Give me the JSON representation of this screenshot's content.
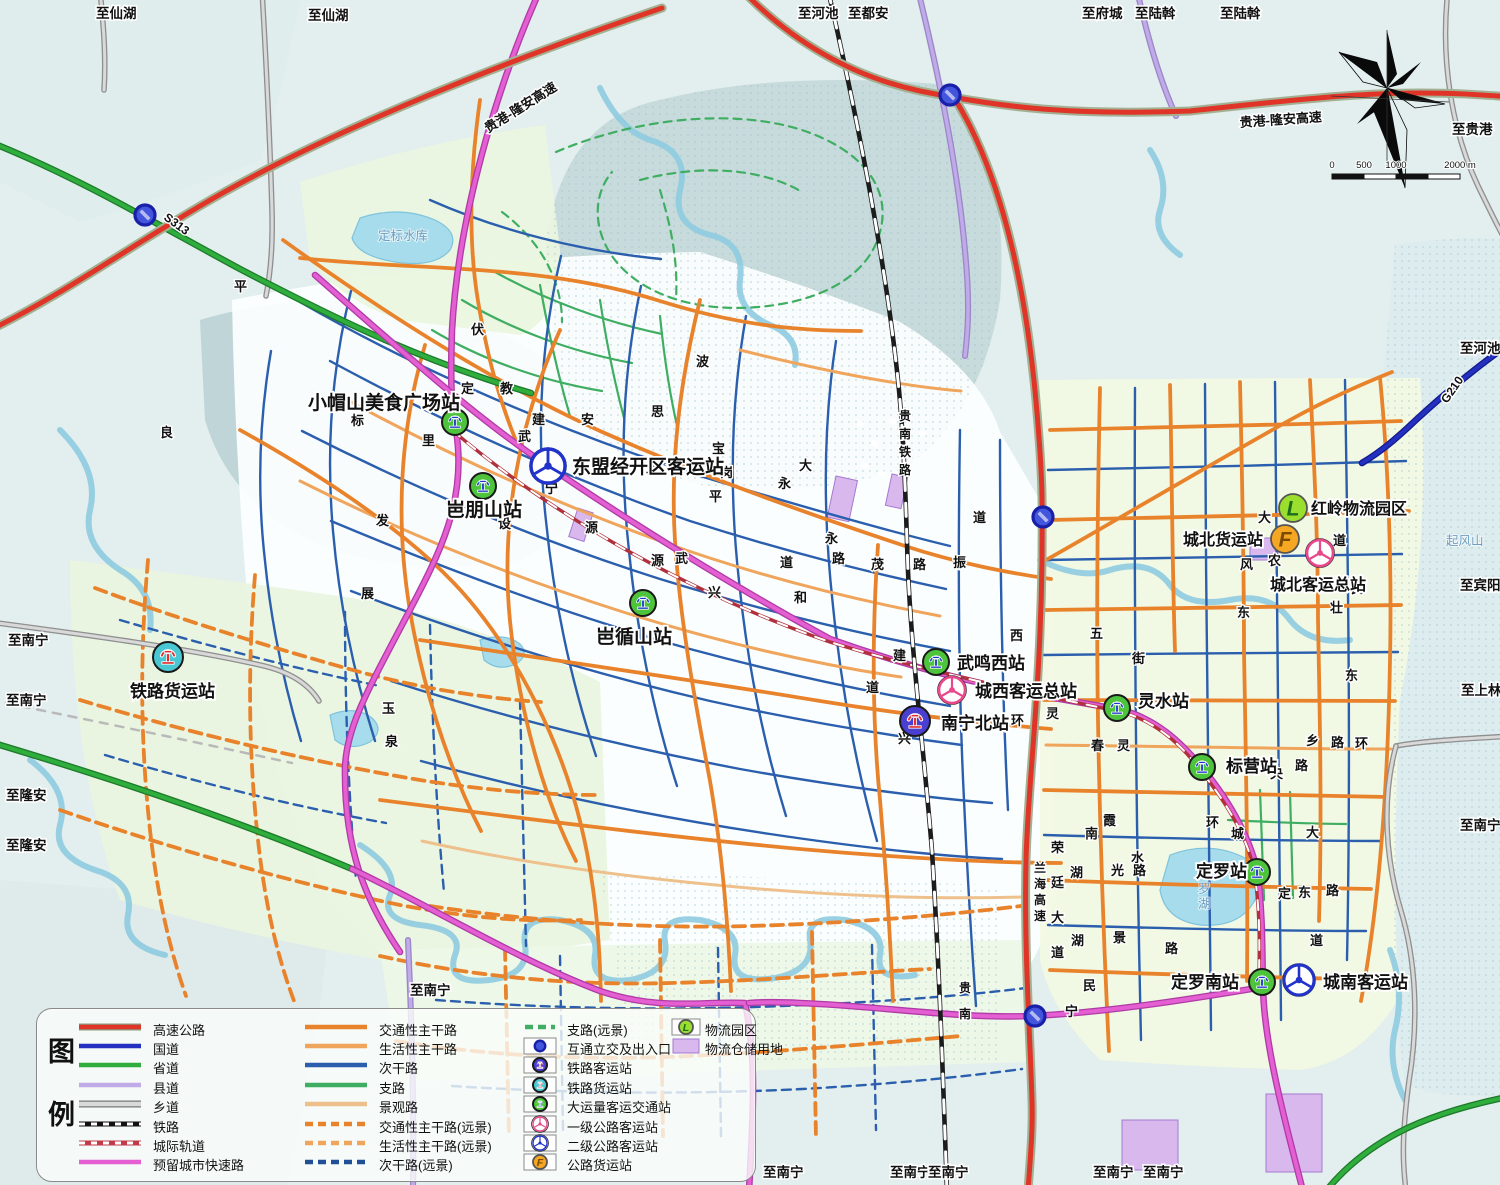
{
  "map": {
    "edge_labels": [
      {
        "text": "至仙湖",
        "x": 96,
        "y": 18
      },
      {
        "text": "至仙湖",
        "x": 308,
        "y": 20
      },
      {
        "text": "至河池",
        "x": 798,
        "y": 18
      },
      {
        "text": "至都安",
        "x": 848,
        "y": 18
      },
      {
        "text": "至府城",
        "x": 1082,
        "y": 18
      },
      {
        "text": "至陆斡",
        "x": 1135,
        "y": 18
      },
      {
        "text": "至陆斡",
        "x": 1220,
        "y": 18
      },
      {
        "text": "至贵港",
        "x": 1452,
        "y": 134
      },
      {
        "text": "至河池",
        "x": 1460,
        "y": 353
      },
      {
        "text": "至宾阳",
        "x": 1460,
        "y": 590
      },
      {
        "text": "至上林",
        "x": 1461,
        "y": 695
      },
      {
        "text": "至南宁",
        "x": 1460,
        "y": 830
      },
      {
        "text": "至南宁",
        "x": 8,
        "y": 645
      },
      {
        "text": "至南宁",
        "x": 6,
        "y": 705
      },
      {
        "text": "至隆安",
        "x": 6,
        "y": 800
      },
      {
        "text": "至隆安",
        "x": 6,
        "y": 850
      },
      {
        "text": "至南宁",
        "x": 410,
        "y": 995
      },
      {
        "text": "至南宁",
        "x": 763,
        "y": 1177
      },
      {
        "text": "至南宁",
        "x": 890,
        "y": 1177
      },
      {
        "text": "至南宁",
        "x": 928,
        "y": 1177
      },
      {
        "text": "至南宁",
        "x": 1093,
        "y": 1177
      },
      {
        "text": "至南宁",
        "x": 1143,
        "y": 1177
      }
    ],
    "route_labels": [
      {
        "text": "贵港-隆安高速",
        "x": 488,
        "y": 133,
        "rot": -32,
        "size": 13
      },
      {
        "text": "贵港-隆安高速",
        "x": 1240,
        "y": 127,
        "rot": -4,
        "size": 13
      },
      {
        "text": "S313",
        "x": 163,
        "y": 219,
        "rot": 36,
        "size": 12
      },
      {
        "text": "G210",
        "x": 1447,
        "y": 404,
        "rot": -55,
        "size": 12
      },
      {
        "text": "贵南铁路",
        "x": 899,
        "y": 420,
        "vsp": 18,
        "size": 12
      },
      {
        "text": "兰海高速",
        "x": 1034,
        "y": 872,
        "vsp": 16,
        "size": 12
      },
      {
        "text": "荣廷大道",
        "x": 1051,
        "y": 852,
        "vsp": 35,
        "size": 13
      },
      {
        "text": "贵南",
        "x": 959,
        "y": 992,
        "vsp": 26,
        "size": 12
      }
    ],
    "water_labels": [
      {
        "text": "定标水库",
        "x": 378,
        "y": 240
      },
      {
        "text": "起风山",
        "x": 1446,
        "y": 545
      },
      {
        "text": "定罗湖",
        "x": 1198,
        "y": 878,
        "vsp": 15
      }
    ],
    "road_chars": [
      [
        "良",
        160,
        437
      ],
      [
        "平",
        234,
        291
      ],
      [
        "伏",
        471,
        334
      ],
      [
        "定",
        461,
        393
      ],
      [
        "教",
        500,
        393
      ],
      [
        "标",
        351,
        425
      ],
      [
        "里",
        422,
        445
      ],
      [
        "建",
        532,
        424
      ],
      [
        "安",
        581,
        424
      ],
      [
        "思",
        651,
        416
      ],
      [
        "波",
        696,
        366
      ],
      [
        "宝",
        712,
        453
      ],
      [
        "岗",
        720,
        477
      ],
      [
        "永",
        778,
        488
      ],
      [
        "大",
        799,
        470
      ],
      [
        "平",
        709,
        501
      ],
      [
        "武",
        518,
        441
      ],
      [
        "宁",
        545,
        493
      ],
      [
        "华",
        646,
        475
      ],
      [
        "发",
        376,
        525
      ],
      [
        "设",
        498,
        528
      ],
      [
        "源",
        585,
        532
      ],
      [
        "武",
        675,
        563
      ],
      [
        "源",
        651,
        565
      ],
      [
        "展",
        361,
        598
      ],
      [
        "玉",
        382,
        713
      ],
      [
        "泉",
        385,
        746
      ],
      [
        "茂",
        871,
        569
      ],
      [
        "路",
        913,
        569
      ],
      [
        "振",
        953,
        567
      ],
      [
        "道",
        973,
        522
      ],
      [
        "西",
        1010,
        640
      ],
      [
        "五",
        1090,
        638
      ],
      [
        "建",
        893,
        660
      ],
      [
        "兴",
        898,
        743
      ],
      [
        "环",
        1011,
        725
      ],
      [
        "灵",
        1046,
        718
      ],
      [
        "春",
        1091,
        750
      ],
      [
        "灵",
        1117,
        750
      ],
      [
        "道",
        866,
        692
      ],
      [
        "街",
        1132,
        663
      ],
      [
        "兴",
        708,
        597
      ],
      [
        "和",
        794,
        602
      ],
      [
        "道",
        780,
        567
      ],
      [
        "路",
        832,
        563
      ],
      [
        "永",
        825,
        543
      ],
      [
        "大",
        1258,
        522
      ],
      [
        "道",
        1333,
        545
      ],
      [
        "风",
        1240,
        569
      ],
      [
        "农",
        1268,
        565
      ],
      [
        "民",
        1351,
        593
      ],
      [
        "东",
        1237,
        617
      ],
      [
        "乡",
        1306,
        745
      ],
      [
        "路",
        1331,
        747
      ],
      [
        "环",
        1355,
        748
      ],
      [
        "央",
        1270,
        778
      ],
      [
        "路",
        1295,
        770
      ],
      [
        "环",
        1206,
        827
      ],
      [
        "城",
        1231,
        838
      ],
      [
        "大",
        1306,
        837
      ],
      [
        "霞",
        1103,
        825
      ],
      [
        "水",
        1131,
        862
      ],
      [
        "光",
        1111,
        875
      ],
      [
        "路",
        1133,
        875
      ],
      [
        "定",
        1278,
        898
      ],
      [
        "东",
        1298,
        897
      ],
      [
        "路",
        1326,
        895
      ],
      [
        "景",
        1113,
        942
      ],
      [
        "路",
        1165,
        953
      ],
      [
        "道",
        1310,
        945
      ],
      [
        "南",
        1085,
        838
      ],
      [
        "湖",
        1070,
        877
      ],
      [
        "湖",
        1071,
        945
      ],
      [
        "民",
        1083,
        990
      ],
      [
        "宁",
        1065,
        1016
      ],
      [
        "东",
        1345,
        680
      ],
      [
        "壮",
        1330,
        612
      ]
    ],
    "stations": [
      {
        "name": "小帽山美食广场站",
        "type": "brt",
        "x": 455,
        "y": 422,
        "lx": 308,
        "ly": 409,
        "lsize": 19
      },
      {
        "name": "东盟经开区客运站",
        "type": "bus2",
        "x": 548,
        "y": 466,
        "r": 17,
        "lx": 572,
        "ly": 473,
        "lsize": 19
      },
      {
        "name": "岜朋山站",
        "type": "brt",
        "x": 483,
        "y": 486,
        "lx": 446,
        "ly": 516,
        "lsize": 19
      },
      {
        "name": "岜循山站",
        "type": "brt",
        "x": 643,
        "y": 603,
        "lx": 596,
        "ly": 643,
        "lsize": 19
      },
      {
        "name": "铁路货运站",
        "type": "rail-freight",
        "x": 168,
        "y": 657,
        "r": 15,
        "lx": 130,
        "ly": 697,
        "lsize": 17
      },
      {
        "name": "武鸣西站",
        "type": "brt",
        "x": 936,
        "y": 662,
        "lx": 957,
        "ly": 669,
        "lsize": 17
      },
      {
        "name": "城西客运总站",
        "type": "bus1",
        "x": 952,
        "y": 690,
        "lx": 975,
        "ly": 697,
        "lsize": 17
      },
      {
        "name": "南宁北站",
        "type": "rail-passenger",
        "x": 915,
        "y": 721,
        "r": 15,
        "lx": 941,
        "ly": 729,
        "lsize": 17
      },
      {
        "name": "灵水站",
        "type": "brt",
        "x": 1117,
        "y": 708,
        "lx": 1138,
        "ly": 707,
        "lsize": 17
      },
      {
        "name": "红岭物流园区",
        "type": "logistics",
        "x": 1293,
        "y": 508,
        "r": 14,
        "lx": 1311,
        "ly": 514,
        "lsize": 16
      },
      {
        "name": "城北货运站",
        "type": "freight",
        "x": 1285,
        "y": 539,
        "r": 14,
        "lx": 1183,
        "ly": 545,
        "lsize": 16
      },
      {
        "name": "城北客运总站",
        "type": "bus1",
        "x": 1320,
        "y": 553,
        "lx": 1270,
        "ly": 590,
        "lsize": 16
      },
      {
        "name": "标营站",
        "type": "brt",
        "x": 1202,
        "y": 767,
        "lx": 1226,
        "ly": 772,
        "lsize": 17
      },
      {
        "name": "定罗站",
        "type": "brt",
        "x": 1257,
        "y": 872,
        "lx": 1196,
        "ly": 877,
        "lsize": 17
      },
      {
        "name": "定罗南站",
        "type": "brt",
        "x": 1262,
        "y": 982,
        "lx": 1171,
        "ly": 988,
        "lsize": 17
      },
      {
        "name": "城南客运站",
        "type": "bus2",
        "x": 1299,
        "y": 980,
        "r": 15,
        "lx": 1323,
        "ly": 988,
        "lsize": 17
      }
    ],
    "interchanges": [
      [
        145,
        215
      ],
      [
        950,
        95
      ],
      [
        1043,
        517
      ],
      [
        1035,
        1016
      ]
    ],
    "scale_bar": {
      "labels": [
        "0",
        "500",
        "1000",
        "2000 m"
      ]
    }
  },
  "legend": {
    "title": "图例",
    "col1": [
      {
        "label": "高速公路",
        "sw": "line",
        "color": "#e03428",
        "casing": "#8a9a7a"
      },
      {
        "label": "国道",
        "sw": "line",
        "color": "#2330c0"
      },
      {
        "label": "省道",
        "sw": "line",
        "color": "#2fae3d"
      },
      {
        "label": "县道",
        "sw": "line",
        "color": "#c0aae8"
      },
      {
        "label": "乡道",
        "sw": "line",
        "color": "#d9d9d9",
        "casing": "#777777"
      },
      {
        "label": "铁路",
        "sw": "rail",
        "color": "#111111"
      },
      {
        "label": "城际轨道",
        "sw": "rail",
        "color": "#c03a4a"
      },
      {
        "label": "预留城市快速路",
        "sw": "line",
        "color": "#e35fd2"
      }
    ],
    "col2": [
      {
        "label": "交通性主干路",
        "sw": "line",
        "color": "#e8832c"
      },
      {
        "label": "生活性主干路",
        "sw": "line",
        "color": "#f0a55c"
      },
      {
        "label": "次干路",
        "sw": "line",
        "color": "#2b5fae"
      },
      {
        "label": "支路",
        "sw": "line",
        "color": "#3fae62"
      },
      {
        "label": "景观路",
        "sw": "line",
        "color": "#eec08c"
      },
      {
        "label": "交通性主干路(远景)",
        "sw": "dash",
        "color": "#e8832c"
      },
      {
        "label": "生活性主干路(远景)",
        "sw": "dash",
        "color": "#f0a55c"
      },
      {
        "label": "次干路(远景)",
        "sw": "dash",
        "color": "#1f4f96"
      }
    ],
    "col3": [
      {
        "label": "支路(远景)",
        "sw": "dash",
        "color": "#3fae62"
      },
      {
        "label": "互通立交及出入口",
        "sw": "icon",
        "icon": "interchange"
      },
      {
        "label": "铁路客运站",
        "sw": "icon",
        "icon": "rail-passenger"
      },
      {
        "label": "铁路货运站",
        "sw": "icon",
        "icon": "rail-freight"
      },
      {
        "label": "大运量客运交通站",
        "sw": "icon",
        "icon": "brt"
      },
      {
        "label": "一级公路客运站",
        "sw": "icon",
        "icon": "bus1"
      },
      {
        "label": "二级公路客运站",
        "sw": "icon",
        "icon": "bus2"
      },
      {
        "label": "公路货运站",
        "sw": "icon",
        "icon": "freight"
      }
    ],
    "col4": [
      {
        "label": "物流园区",
        "sw": "icon",
        "icon": "logistics"
      },
      {
        "label": "物流仓储用地",
        "sw": "rect",
        "color": "#d9b8ee"
      }
    ]
  }
}
